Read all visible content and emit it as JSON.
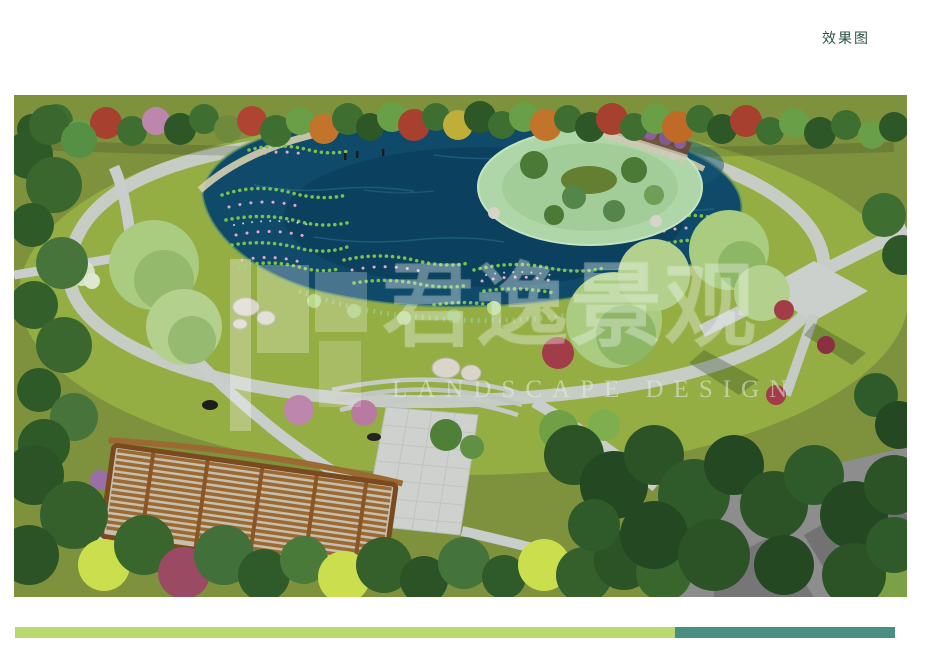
{
  "header": {
    "title": "效果图"
  },
  "watermark": {
    "cn": "君逸景观",
    "en": "LANDSCAPE DESIGN"
  },
  "palette": {
    "header_text": "#2c5244",
    "bar_left": "#b9d96f",
    "bar_right": "#4a8d81",
    "lawn_outer": "#7e923e",
    "lawn_inner": "#95ae44",
    "pond": "#0f4a6a",
    "pond_deep": "#0a3a55",
    "path_gray": "#c9cdcb",
    "island": "#aed6a8",
    "wood": "#9b6a33",
    "conifer": "#2c5326",
    "road": "#8d8d8d",
    "lotus_green": "#7cc24a",
    "lotus_pink": "#e8a8c8"
  }
}
